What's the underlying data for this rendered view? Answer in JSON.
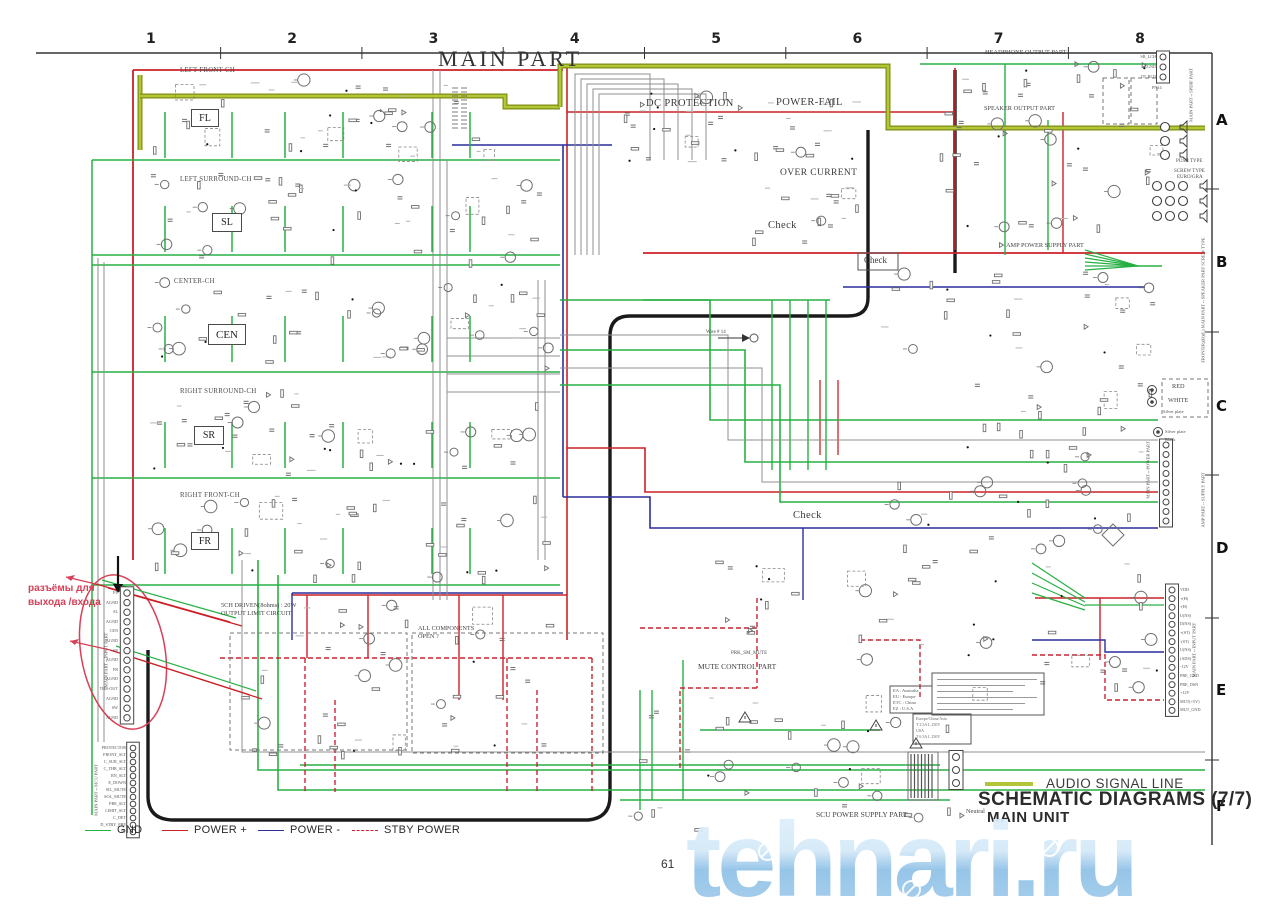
{
  "page": {
    "title": "MAIN PART",
    "page_number": "61",
    "watermark": "tehnari.ru"
  },
  "grid": {
    "columns": [
      "1",
      "2",
      "3",
      "4",
      "5",
      "6",
      "7",
      "8"
    ],
    "rows": [
      "A",
      "B",
      "C",
      "D",
      "E",
      "F"
    ]
  },
  "legend": {
    "gnd": "GND",
    "power_plus": "POWER +",
    "power_minus": "POWER -",
    "stby": "STBY POWER"
  },
  "title_block": {
    "audio_line_label": "AUDIO SIGNAL LINE",
    "sheet_title": "SCHEMATIC DIAGRAMS (7/7)",
    "sheet_subtitle": "MAIN UNIT"
  },
  "colors": {
    "gnd": "#27b043",
    "pplus": "#cc2127",
    "pminus": "#2a2f9c",
    "stby": "#cb2430",
    "audio_outer": "#7c8f13",
    "audio_inner": "#b4c637",
    "black": "#1a1a1a",
    "gray": "#8f8f8f",
    "comp": "#6f6f6f",
    "annot": "#d84058",
    "frame": "#333333"
  },
  "channels": [
    {
      "header": "LEFT FRONT-CH",
      "tag": "FL"
    },
    {
      "header": "LEFT SURROUND-CH",
      "tag": "SL"
    },
    {
      "header": "CENTER-CH",
      "tag": "CEN"
    },
    {
      "header": "RIGHT SURROUND-CH",
      "tag": "SR"
    },
    {
      "header": "RIGHT FRONT-CH",
      "tag": "FR"
    }
  ],
  "section_labels": {
    "dc_protection": "DC PROTECTION",
    "power_fail": "POWER-FAIL",
    "over_current": "OVER CURRENT",
    "check": "Check",
    "headphone": "HEADPHONE OUTPUT PART",
    "speaker": "SPEAKER OUTPUT PART",
    "amp_supply": "AMP POWER SUPPLY PART",
    "mute": "MUTE CONTROL PART",
    "prk": "PRK_SM_MUTE",
    "scu": "SCU POWER SUPPLY PART",
    "limit1": "5CH DRIVEN(8ohms) : 20W",
    "limit2": "OUTPUT LIMIT CIRCUIT",
    "allcomp1": "ALL COMPONENTS",
    "allcomp2": "OPEN ?",
    "push_type": "PUSH TYPE",
    "screw_type": "SCREW TYPE",
    "screw_sub": "EURO/GRA",
    "neutral": "Neutral",
    "wire14": "Wire # 14",
    "red": "RED",
    "white": "WHITE",
    "silver": "Silver plate",
    "black_lbl": "Black"
  },
  "region_codes": [
    "EA : Australia",
    "EU : Europe",
    "ETC : China",
    "EZ : U.S.A"
  ],
  "fuse_box": {
    "title": "Europe/China/Asia",
    "line1": "T 2.5A L 250V",
    "line2": "USA",
    "line3": "T 6.3A L 250V"
  },
  "annotation_ru": {
    "line1": "разъёмы для",
    "line2": "выхода /входа"
  },
  "connectors": {
    "input_left": {
      "label": "MAIN PART↔INPUT PART",
      "pins": [
        "FL",
        "AGND",
        "SL",
        "AGND",
        "CEN",
        "AGND",
        "SR",
        "AGND",
        "FR",
        "AGND",
        "THR-OUT",
        "AGND",
        "SW",
        "AGND"
      ]
    },
    "mcu": {
      "label": "MAIN PART↔MCU PART",
      "pins": [
        "PROTECTOR",
        "FRONT_SLT",
        "C_SUR_SLT",
        "C_THR_SLT",
        "RN_SLT",
        "E_DOWN",
        "SIL_MUTE",
        "SOL_MUTE",
        "PRE_SLT",
        "LIMIT_SLT",
        "C_DET",
        "D_STBY_PRE",
        "5V"
      ]
    },
    "input_right": {
      "label": "MAIN PART↔INPUT PART",
      "pins": [
        "VDD",
        "+(H)",
        "-(H)",
        "U(NS)",
        "D(NS)",
        "+(ST)",
        "-(ST)",
        "U(NS)",
        "(ADS)",
        "-12V",
        "PRE_GND",
        "PRE_DSN",
        "+12V",
        "MUT(+5V)",
        "MUT_GND"
      ]
    },
    "headphone": {
      "tag": "PN14",
      "pins": [
        "SR_LCH",
        "AGND",
        "TP_RLD"
      ]
    },
    "spdif": {
      "label": "MAIN PART↔SPDIF PART"
    },
    "speaker": {
      "label": "FRONT(R)(B)(L) MAIN PART↔SPEAKER PART SCREW TYPE"
    },
    "power_right": {
      "label": "MAIN PART↔POWER PART"
    },
    "amp_right": {
      "label": "AMP PART↔SUPPLY PART"
    }
  }
}
